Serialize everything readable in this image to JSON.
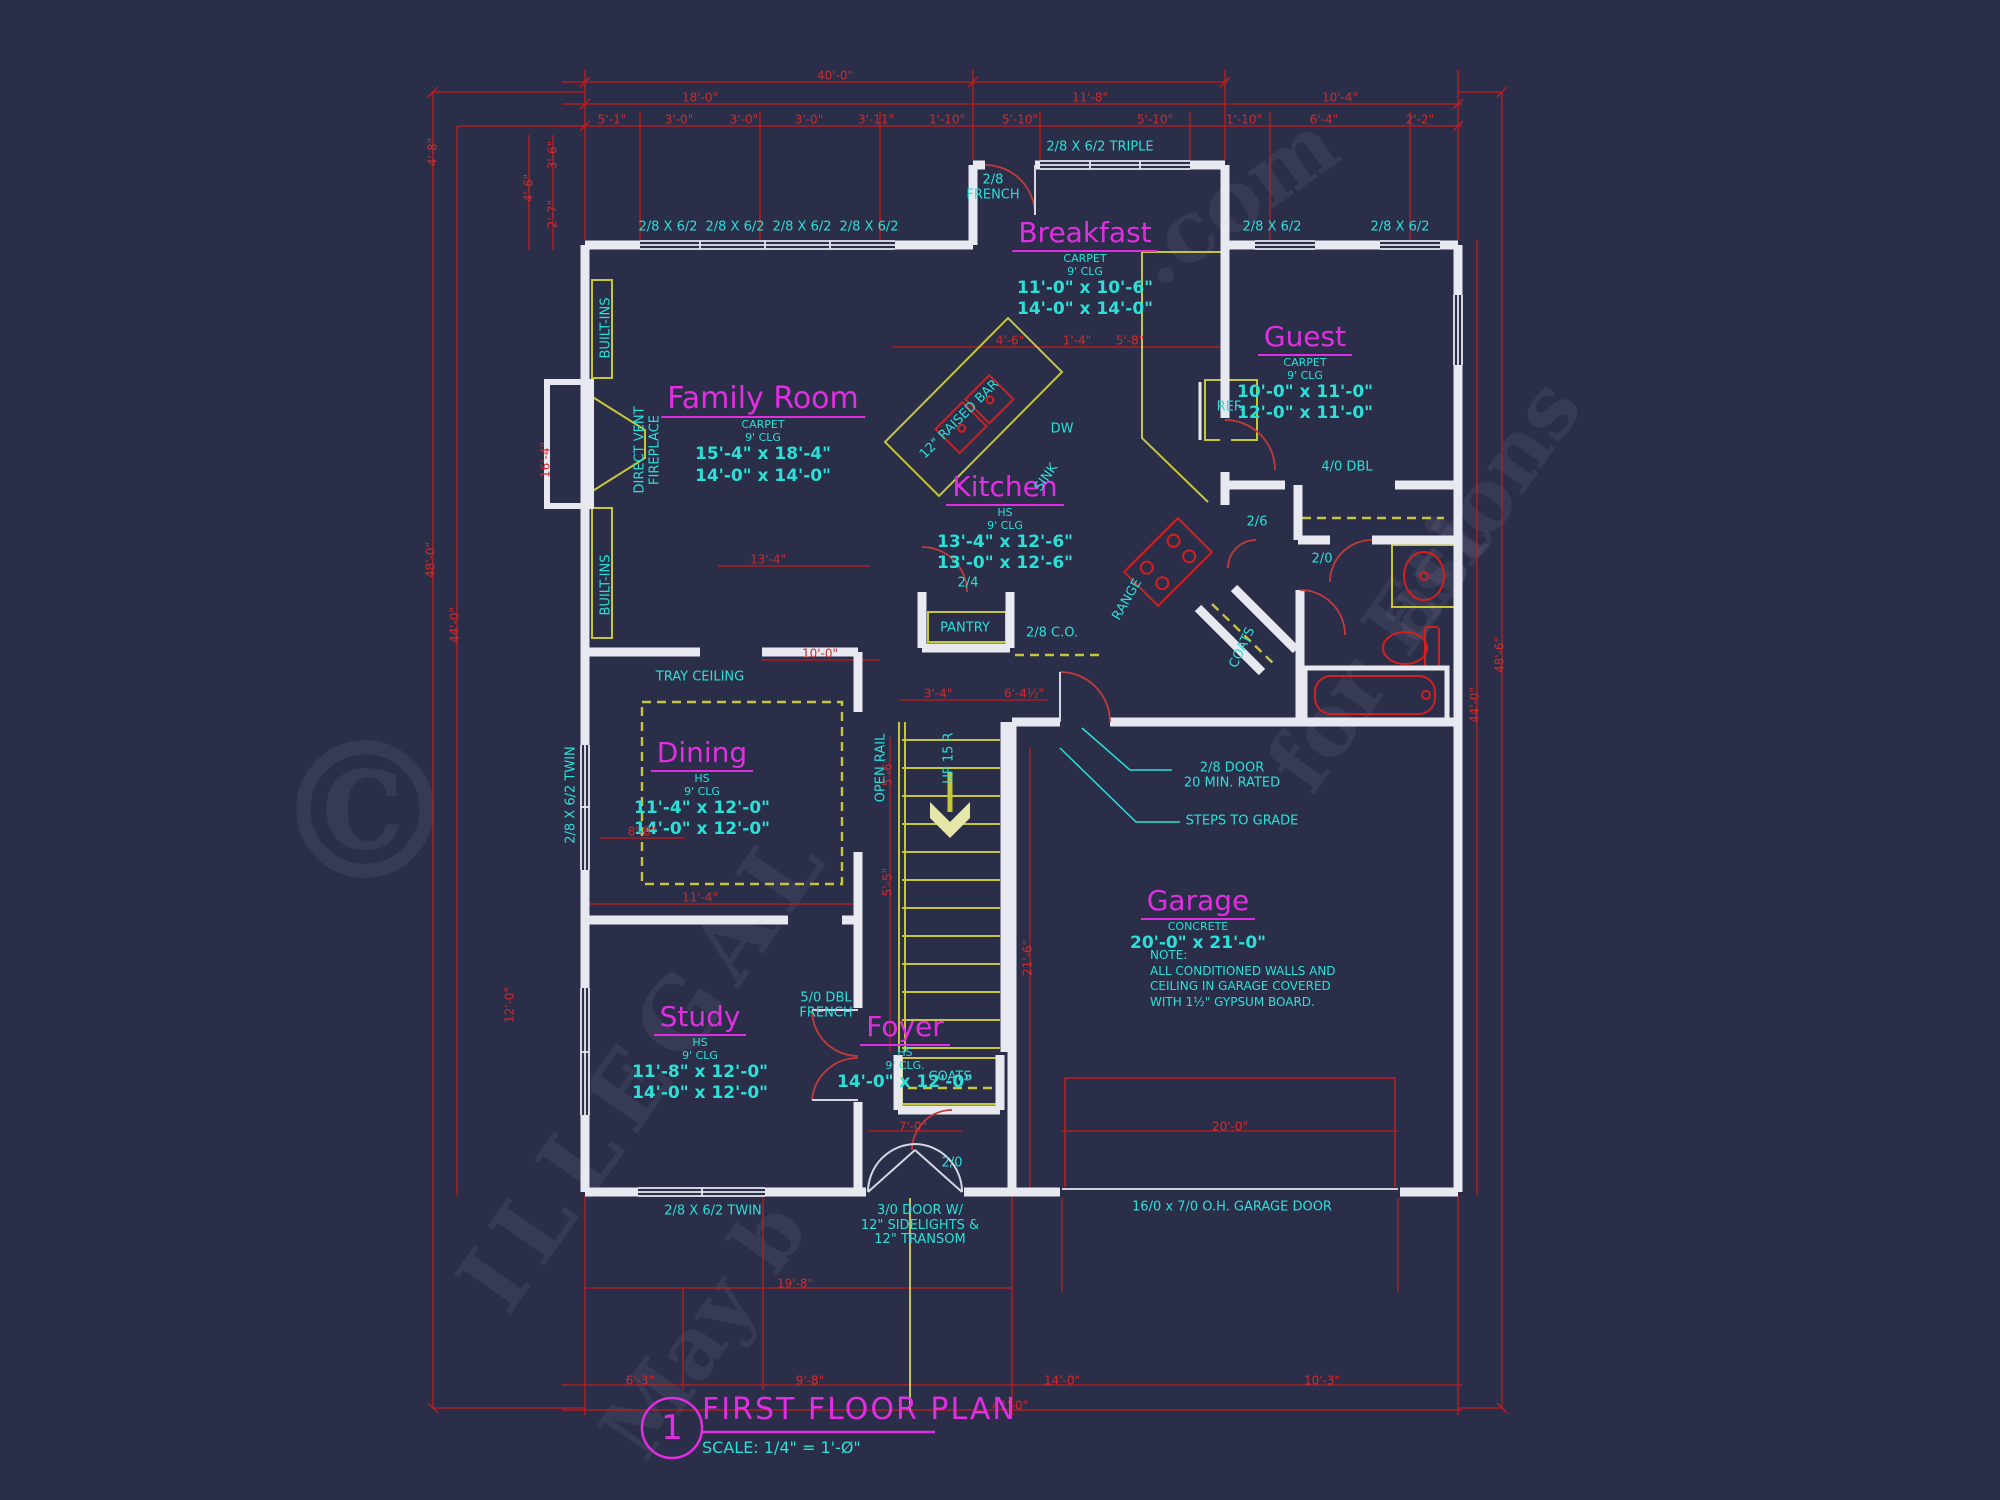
{
  "title_block": {
    "number": "1",
    "title": "FIRST FLOOR PLAN",
    "scale": "SCALE: 1/4\" = 1'-Ø\""
  },
  "colors": {
    "background": "#2a2e49",
    "dimension_red": "#c11d1d",
    "wall_white": "#e8e8f0",
    "cabinet_olive": "#c6c63a",
    "annotation_cyan": "#2be0d7",
    "room_magenta": "#e22ee2"
  },
  "rooms": [
    {
      "name": "Family Room",
      "lines": [
        "CARPET",
        "9' CLG",
        "15'-4\" x 18'-4\"",
        "14'-0\" x 14'-0\""
      ]
    },
    {
      "name": "Breakfast",
      "lines": [
        "CARPET",
        "9' CLG",
        "11'-0\" x 10'-6\"",
        "14'-0\" x 14'-0\""
      ]
    },
    {
      "name": "Guest",
      "lines": [
        "CARPET",
        "9' CLG",
        "10'-0\" x 11'-0\"",
        "12'-0\" x 11'-0\""
      ]
    },
    {
      "name": "Kitchen",
      "lines": [
        "HS",
        "9' CLG",
        "13'-4\" x 12'-6\"",
        "13'-0\" x 12'-6\""
      ]
    },
    {
      "name": "Dining",
      "lines": [
        "HS",
        "9' CLG",
        "11'-4\" x 12'-0\"",
        "14'-0\" x 12'-0\""
      ]
    },
    {
      "name": "Study",
      "lines": [
        "HS",
        "9' CLG",
        "11'-8\" x 12'-0\"",
        "14'-0\" x 12'-0\""
      ]
    },
    {
      "name": "Foyer",
      "lines": [
        "HS",
        "9' CLG.",
        "14'-0\" x 12'-0\""
      ]
    },
    {
      "name": "Garage",
      "lines": [
        "CONCRETE",
        "20'-0\" x 21'-0\""
      ],
      "note": "NOTE:\nALL CONDITIONED WALLS AND\nCEILING IN GARAGE COVERED\nWITH 1½\" GYPSUM BOARD."
    }
  ],
  "ann": [
    "2/8\nFRENCH",
    "2/8 X 6/2 TRIPLE",
    "2/8 X 6/2",
    "2/8 X 6/2",
    "2/8 X 6/2",
    "2/8 X 6/2",
    "2/8 X 6/2",
    "2/8 X 6/2",
    "BUILT-INS",
    "BUILT-INS",
    "DIRECT VENT\nFIREPLACE",
    "TRAY CEILING",
    "2/8 X 6/2 TWIN",
    "2/8 X 6/2 TWIN",
    "OPEN RAIL",
    "UP 15 R",
    "COATS",
    "COATS",
    "PANTRY",
    "2/4",
    "2/8 C.O.",
    "2/6",
    "2/0",
    "2/0",
    "4/0 DBL",
    "5/0 DBL\nFRENCH",
    "REF.",
    "DW",
    "SINK",
    "12\" RAISED BAR",
    "RANGE",
    "2/8 DOOR\n20 MIN. RATED",
    "STEPS TO GRADE",
    "3/0 DOOR W/\n12\" SIDELIGHTS &\n12\" TRANSOM",
    "16/0 x 7/0 O.H. GARAGE DOOR"
  ],
  "dims": [
    "40'-0\"",
    "18'-0\"",
    "11'-8\"",
    "10'-4\"",
    "5'-1\"",
    "3'-0\"",
    "3'-0\"",
    "3'-0\"",
    "3'-11\"",
    "1'-10\"",
    "5'-10\"",
    "5'-10\"",
    "1'-10\"",
    "6'-4\"",
    "2'-2\"",
    "4'-8\"",
    "48'-0\"",
    "44'-0\"",
    "4'-6\"",
    "3'-6\"",
    "2'-7\"",
    "16'-4\"",
    "12'-0\"",
    "48'-6\"",
    "44'-0\"",
    "21'-6\"",
    "5'-6\"",
    "5'-5\"",
    "19'-8\"",
    "7'-0\"",
    "20'-0\"",
    "6'-3\"",
    "9'-8\"",
    "14'-0\"",
    "10'-3\"",
    "41'-0\"",
    "13'-4\"",
    "10'-0\"",
    "8'-8\"",
    "11'-4\"",
    "3'-4\"",
    "6'-4½\"",
    "4'-6\"",
    "1'-4\"",
    "5'-8\""
  ],
  "watermark": [
    "©",
    "ILLEGAL",
    "May b",
    "for Est",
    "ations",
    ".com"
  ]
}
